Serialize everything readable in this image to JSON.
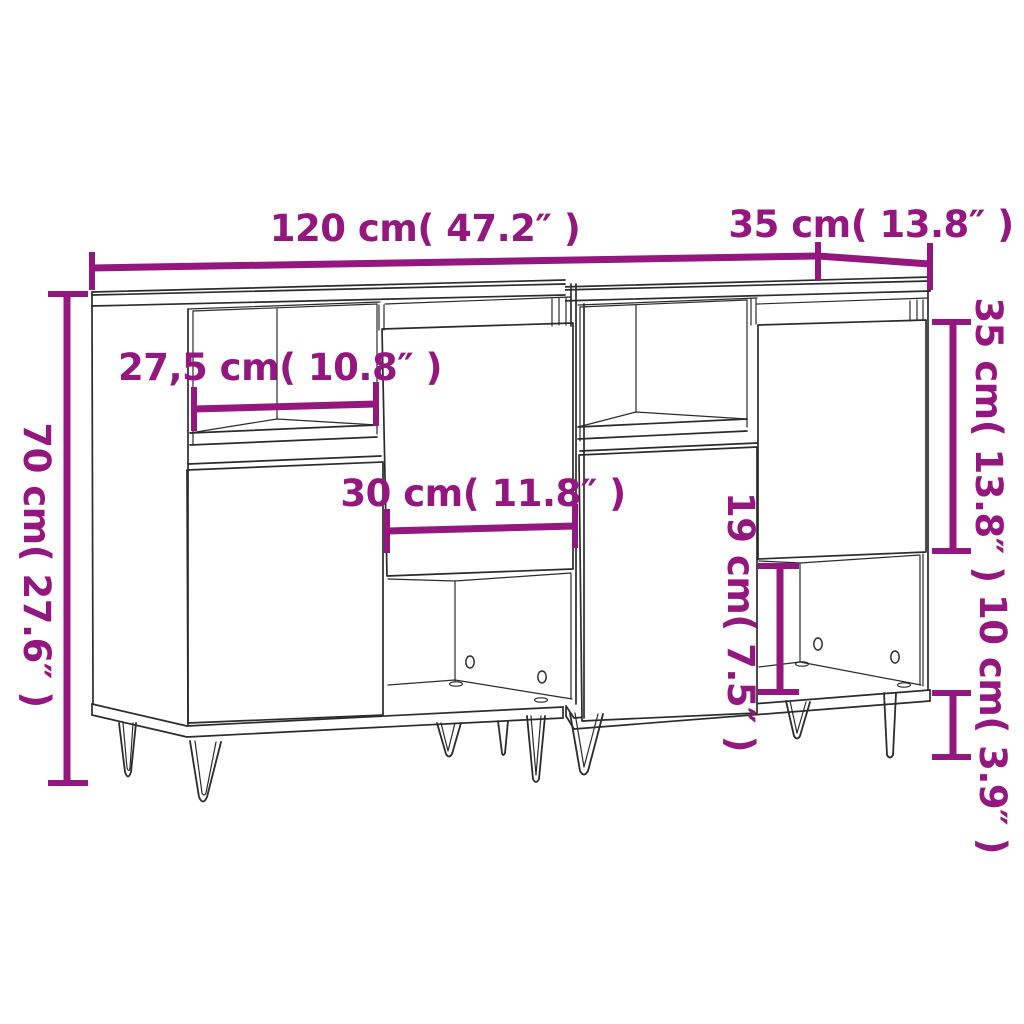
{
  "diagram": {
    "title": "sideboard pair dimension drawing",
    "background": "#ffffff",
    "accent_color": "#93177E",
    "line_color": "#2b2b2b",
    "units": [
      "cm",
      "inch"
    ],
    "labels": {
      "total_width": "120 cm( 47.2″ )",
      "depth": "35 cm( 13.8″ )",
      "total_height": "70 cm( 27.6″ )",
      "shelf_width_left": "27,5 cm( 10.8″ )",
      "shelf_width_center": "30 cm( 11.8″ )",
      "door_height_right": "35 cm( 13.8″ )",
      "compartment_height": "19 cm( 7.5″ )",
      "leg_height": "10 cm( 3.9″ )"
    },
    "measurements": [
      {
        "name": "total width",
        "cm": 120,
        "inch": 47.2
      },
      {
        "name": "depth",
        "cm": 35,
        "inch": 13.8
      },
      {
        "name": "total height",
        "cm": 70,
        "inch": 27.6
      },
      {
        "name": "open shelf width left",
        "cm": 27.5,
        "inch": 10.8
      },
      {
        "name": "open shelf width center",
        "cm": 30,
        "inch": 11.8
      },
      {
        "name": "door height right",
        "cm": 35,
        "inch": 13.8
      },
      {
        "name": "lower compartment height",
        "cm": 19,
        "inch": 7.5
      },
      {
        "name": "leg height",
        "cm": 10,
        "inch": 3.9
      }
    ]
  }
}
